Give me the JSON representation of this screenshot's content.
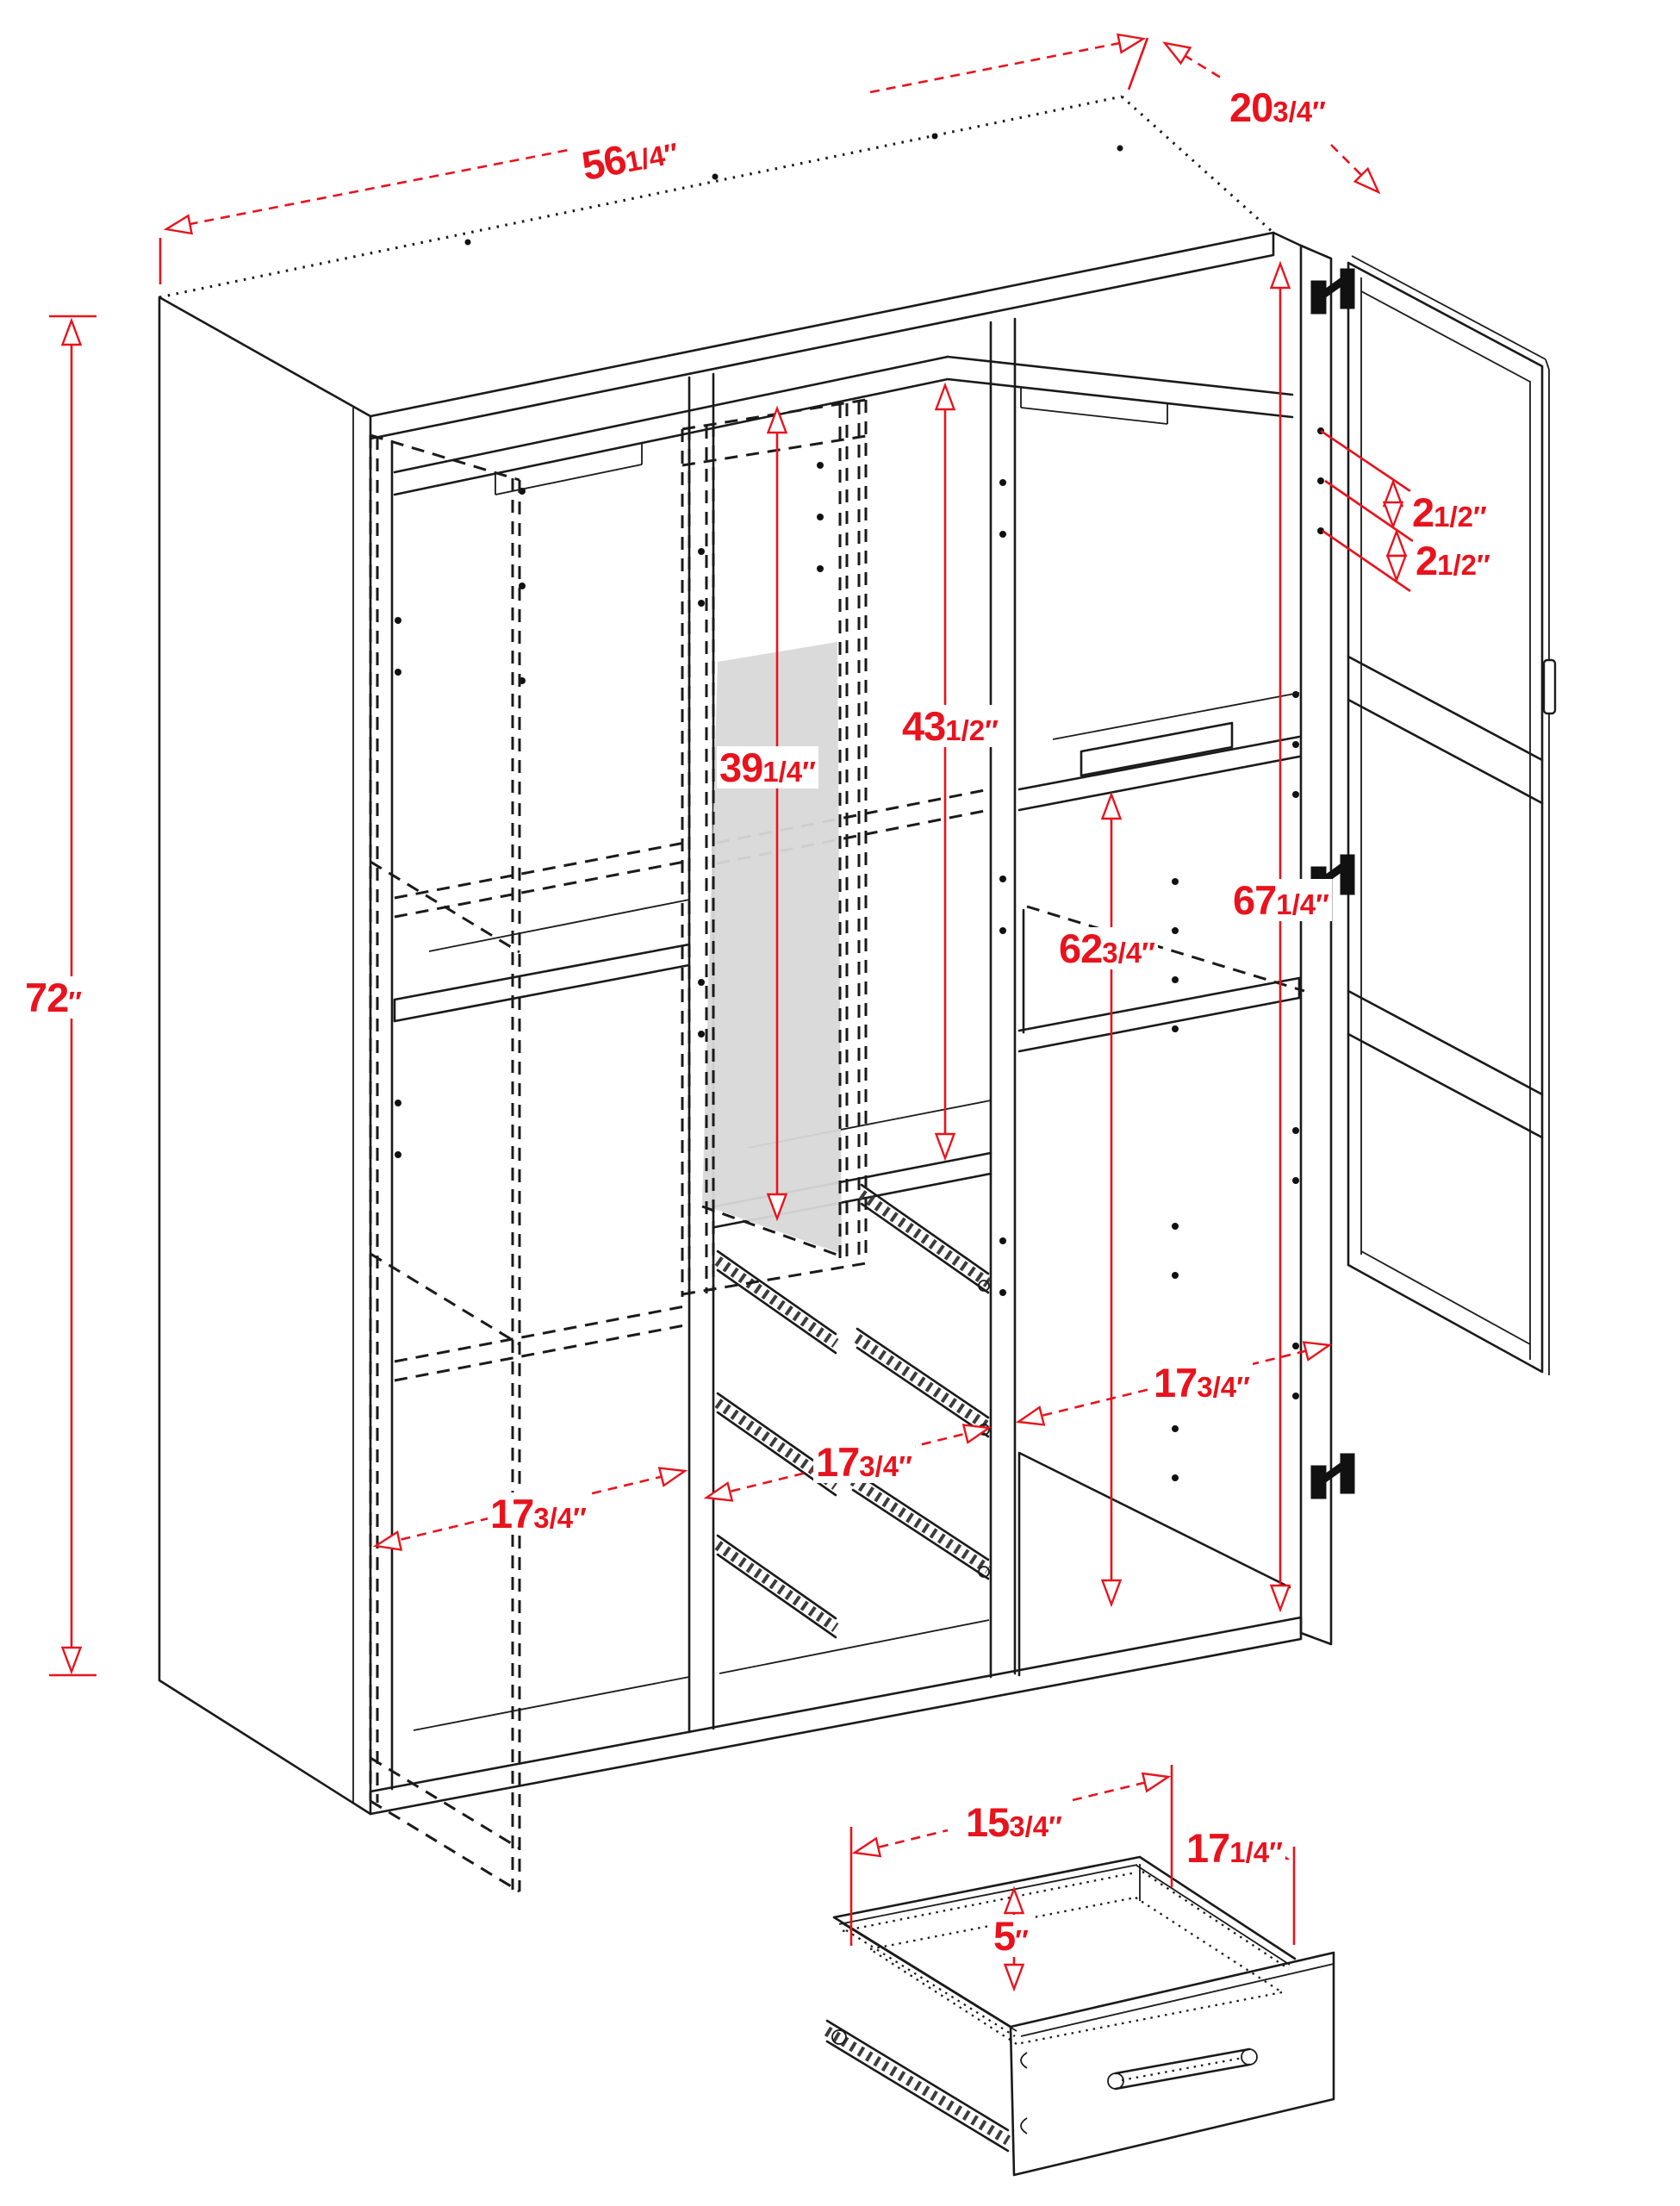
{
  "drawing": {
    "type": "wardrobe-dimension-diagram",
    "subject": "Three-section wardrobe shown open with interior shelves, drawer slides, mirror door and a separate drawer detail",
    "background_color": "#ffffff",
    "line_color": "#1a1a1a",
    "dimension_color": "#e8131d",
    "mirror_fill_color": "#d8d8d8"
  },
  "dims": {
    "overall_width": {
      "whole": "56",
      "frac": "1/4",
      "unit": "″"
    },
    "overall_depth": {
      "whole": "20",
      "frac": "3/4",
      "unit": "″"
    },
    "overall_height": {
      "whole": "72",
      "frac": "",
      "unit": "″"
    },
    "hole_spacing_upper": {
      "whole": "2",
      "frac": "1/2",
      "unit": "″"
    },
    "hole_spacing_lower": {
      "whole": "2",
      "frac": "1/2",
      "unit": "″"
    },
    "mirror_door_height": {
      "whole": "39",
      "frac": "1/4",
      "unit": "″"
    },
    "middle_interior_height": {
      "whole": "43",
      "frac": "1/2",
      "unit": "″"
    },
    "right_interior_height": {
      "whole": "67",
      "frac": "1/4",
      "unit": "″"
    },
    "right_shelf_height": {
      "whole": "62",
      "frac": "3/4",
      "unit": "″"
    },
    "left_section_width": {
      "whole": "17",
      "frac": "3/4",
      "unit": "″"
    },
    "middle_section_width": {
      "whole": "17",
      "frac": "3/4",
      "unit": "″"
    },
    "right_section_width": {
      "whole": "17",
      "frac": "3/4",
      "unit": "″"
    },
    "drawer_width": {
      "whole": "15",
      "frac": "3/4",
      "unit": "″"
    },
    "drawer_depth": {
      "whole": "17",
      "frac": "1/4",
      "unit": "″"
    },
    "drawer_height": {
      "whole": "5",
      "frac": "",
      "unit": "″"
    }
  }
}
